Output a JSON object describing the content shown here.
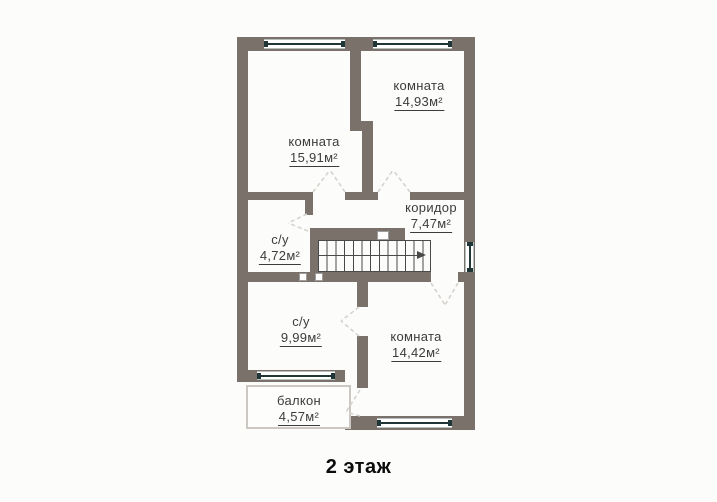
{
  "title": "2 этаж",
  "colors": {
    "wall": "#7a716b",
    "background": "#fcfcfb",
    "text": "#3c3c3c",
    "glass": "#203636",
    "door_dash": "#d6d2cd"
  },
  "rooms": [
    {
      "id": "room-top-right",
      "name": "комната",
      "area": "14,93м²"
    },
    {
      "id": "room-top-left",
      "name": "комната",
      "area": "15,91м²"
    },
    {
      "id": "corridor",
      "name": "коридор",
      "area": "7,47м²"
    },
    {
      "id": "bathroom-small",
      "name": "с/у",
      "area": "4,72м²"
    },
    {
      "id": "bathroom-large",
      "name": "с/у",
      "area": "9,99м²"
    },
    {
      "id": "room-bottom-right",
      "name": "комната",
      "area": "14,42м²"
    },
    {
      "id": "balcony",
      "name": "балкон",
      "area": "4,57м²"
    }
  ]
}
